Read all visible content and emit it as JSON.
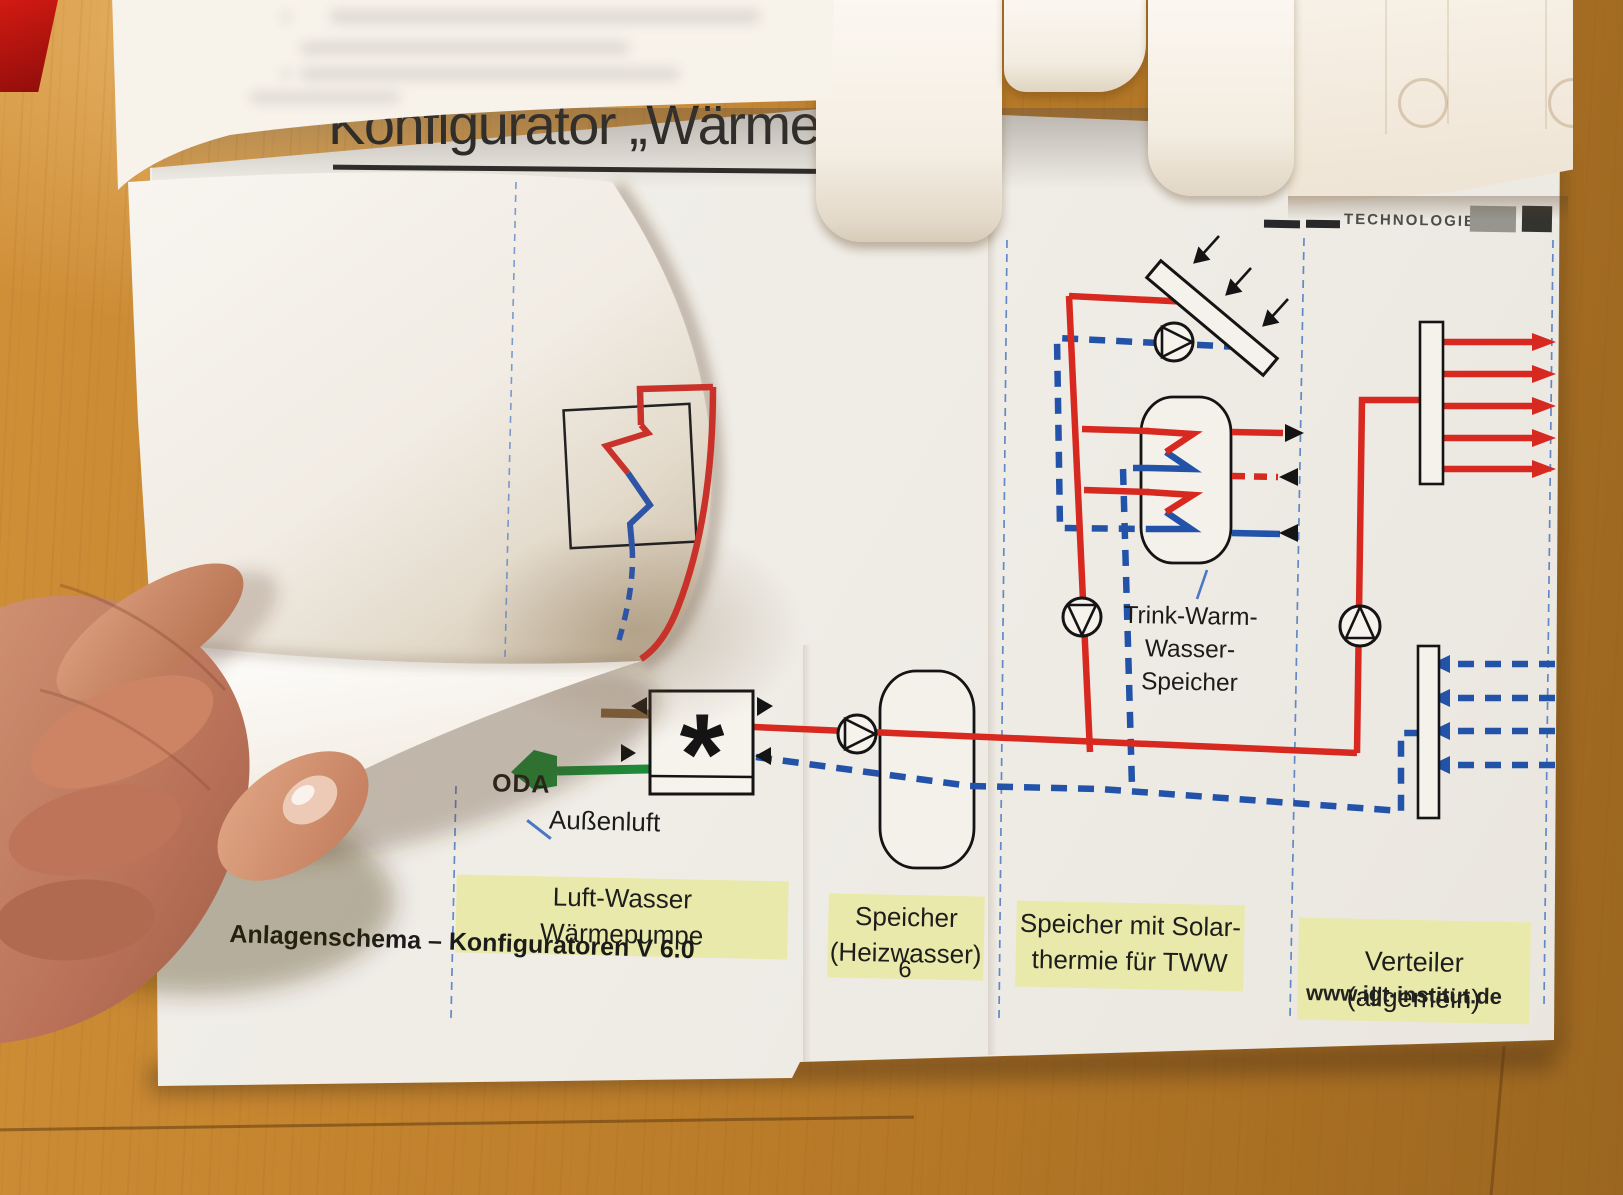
{
  "page": {
    "title": "Konfigurator „Wärme“",
    "brand": "TECHNOLOGIE",
    "footer_version": "Anlagenschema – Konfiguratoren V 6.0",
    "page_number": "6",
    "website": "www.igt-institut.de"
  },
  "diagram": {
    "heat_pump_symbol": "*",
    "oda_label": "ODA",
    "outdoor_air_label": "Außenluft",
    "dhw_tank_label": "Trink-Warm-\nWasser-\nSpeicher",
    "strips": [
      {
        "label": "Luft-Wasser\nWärmepumpe"
      },
      {
        "label": "Speicher\n(Heizwasser)"
      },
      {
        "label": "Speicher mit Solar-\nthermie für TWW"
      },
      {
        "label": "Verteiler (allgemein)"
      }
    ],
    "colors": {
      "supply_line": "#d7291f",
      "return_line": "#2353a8",
      "fresh_air_line": "#1e8a38",
      "exhaust_air_line": "#8a6a40",
      "label_background": "#e9e9ab",
      "paper": "#f4f1ea",
      "wood_table": "#c4842e"
    }
  }
}
